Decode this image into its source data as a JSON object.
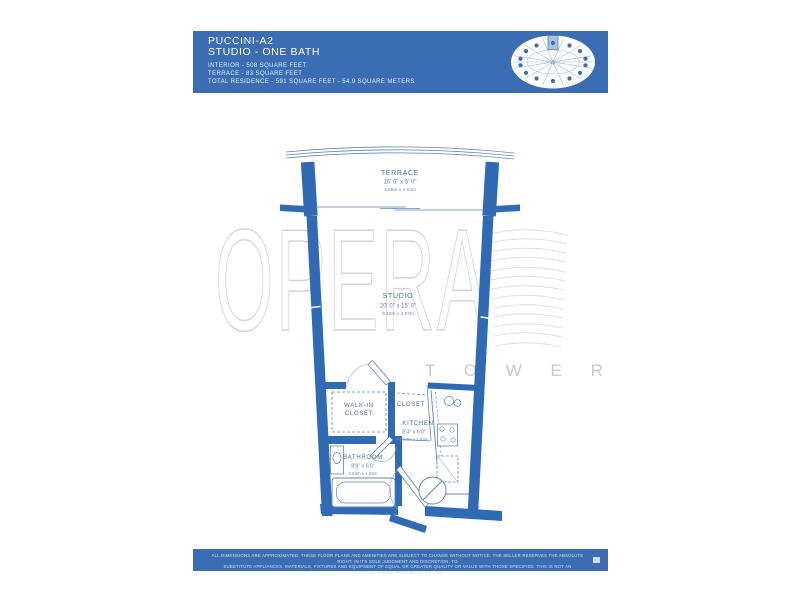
{
  "colors": {
    "brand_blue": "#3a6db4",
    "wall_blue": "#2f6ab2",
    "plan_line_blue": "#5e86ba",
    "label_blue": "#4d6e9e",
    "keyplate_highlight": "#a9c3e2",
    "watermark_gray": "#d4d4d4"
  },
  "header": {
    "unit_name": "PUCCINI-A2",
    "unit_type": "STUDIO - ONE BATH",
    "stats": [
      "INTERIOR - 508 SQUARE FEET",
      "TERRACE - 83 SQUARE FEET",
      "TOTAL RESIDENCE - 591 SQUARE FEET - 54.9 SQUARE METERS"
    ],
    "keyplate": {
      "unit_number": "4"
    }
  },
  "watermark": {
    "brand": "OPERA",
    "sub": "T O W E R"
  },
  "floorplan": {
    "terrace": {
      "name": "TERRACE",
      "imperial": "16' 6\" x 5' 0\"",
      "metric": "4.88m x 1.52m"
    },
    "studio": {
      "name": "STUDIO",
      "imperial": "20' 0\" x 15' 0\"",
      "metric": "6.10m x 4.57m"
    },
    "walk_in_closet": {
      "line1": "WALK-IN",
      "line2": "CLOSET"
    },
    "closet": {
      "name": "CLOSET"
    },
    "kitchen": {
      "name": "KITCHEN",
      "imperial": "8'4\" x 6'0\"",
      "metric": "2.54m x 1.83m"
    },
    "bathroom": {
      "name": "BATHROOM",
      "imperial": "8'8\" x 6'0\"",
      "metric": "2.64m x 1.83m"
    }
  },
  "footer": {
    "line1": "ALL DIMENSIONS ARE APPROXIMATED. THESE FLOOR PLANS AND AMENITIES ARE SUBJECT TO CHANGE WITHOUT NOTICE. THE SELLER RESERVES THE ABSOLUTE RIGHT, IN ITS SOLE JUDGMENT AND DISCRETION, TO",
    "line2": "SUBSTITUTE APPLIANCES, MATERIALS, FIXTURES AND EQUIPMENT OF EQUAL OR GREATER QUALITY OR VALUE WITH THOSE SPECIFIED. THIS IS NOT AN OFFERING WHERE PROHIBITED BY LAW."
  }
}
